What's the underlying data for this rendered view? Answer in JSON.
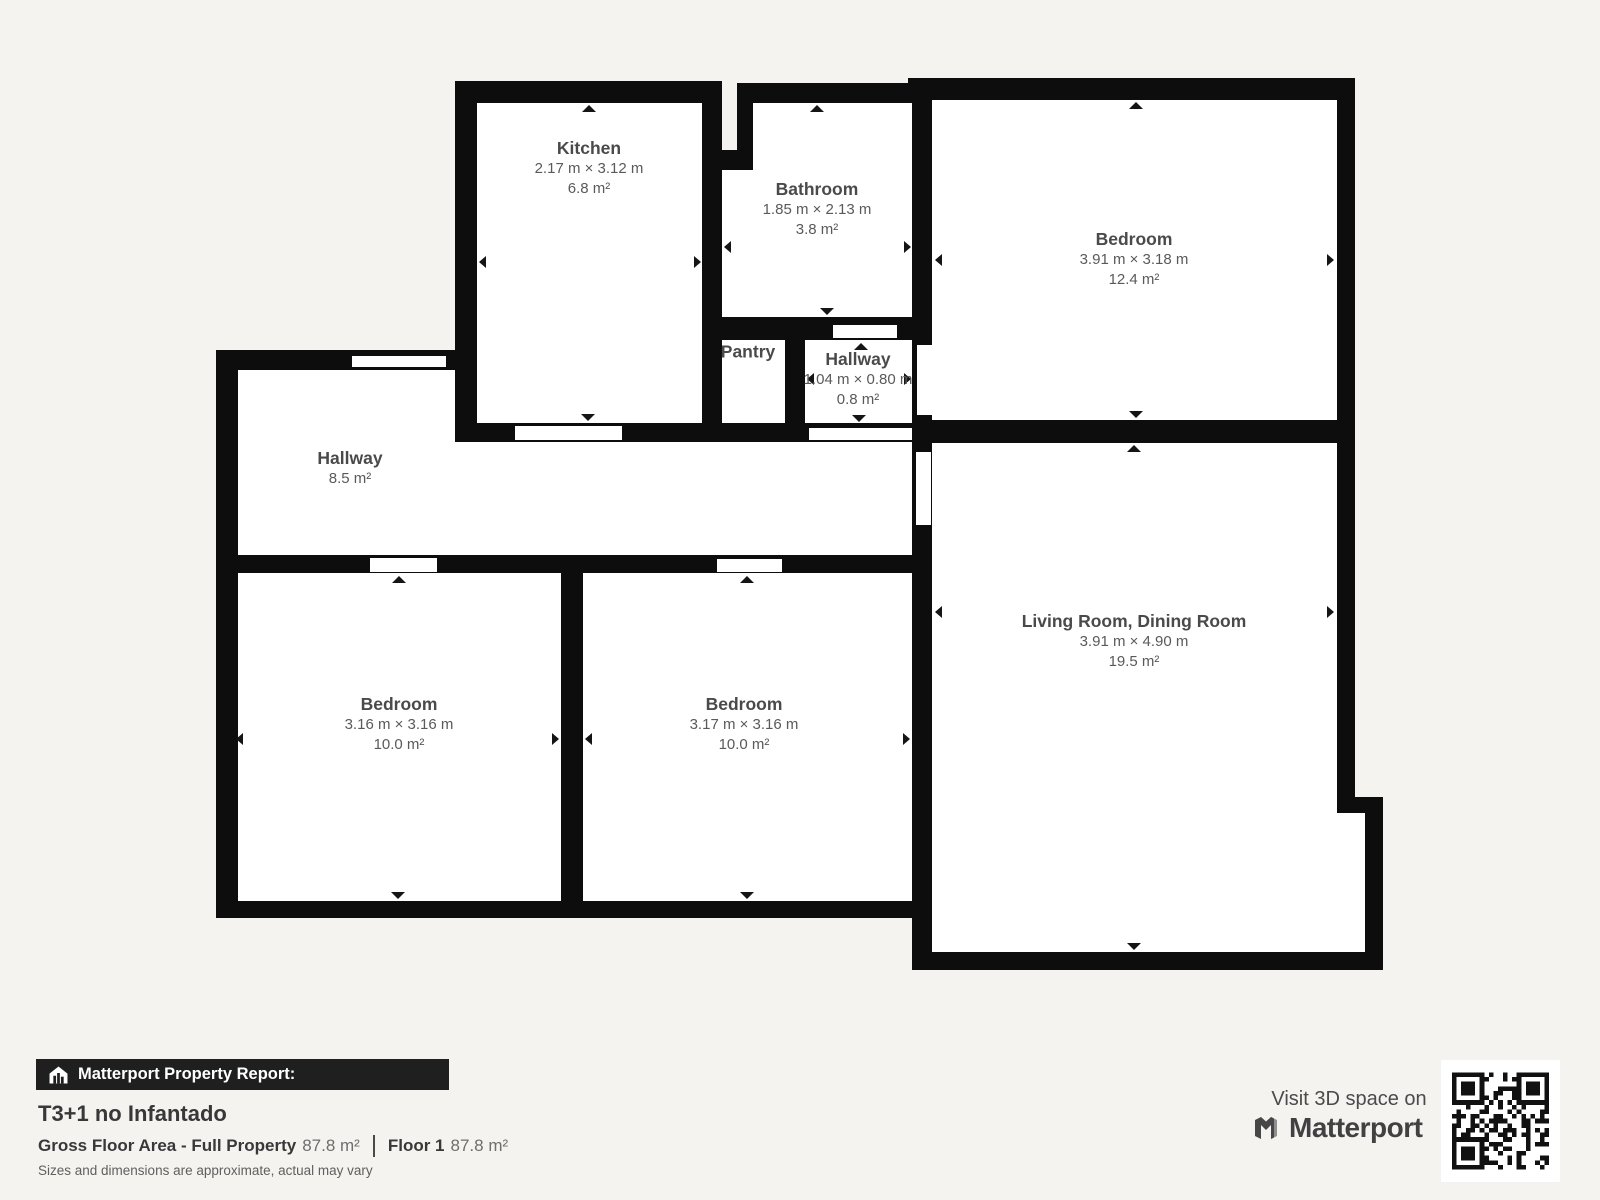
{
  "rooms": {
    "kitchen": {
      "name": "Kitchen",
      "dims": "2.17 m × 3.12 m",
      "area": "6.8 m²"
    },
    "bathroom": {
      "name": "Bathroom",
      "dims": "1.85 m × 2.13 m",
      "area": "3.8 m²"
    },
    "bedroom_top_right": {
      "name": "Bedroom",
      "dims": "3.91 m × 3.18 m",
      "area": "12.4 m²"
    },
    "pantry": {
      "name": "Pantry"
    },
    "hallway_small": {
      "name": "Hallway",
      "dims": "1.04 m × 0.80 m",
      "area": "0.8 m²"
    },
    "hallway_main": {
      "name": "Hallway",
      "area": "8.5 m²"
    },
    "bedroom_bottom_left": {
      "name": "Bedroom",
      "dims": "3.16 m × 3.16 m",
      "area": "10.0 m²"
    },
    "bedroom_bottom_middle": {
      "name": "Bedroom",
      "dims": "3.17 m × 3.16 m",
      "area": "10.0 m²"
    },
    "living_room": {
      "name": "Living Room, Dining Room",
      "dims": "3.91 m × 4.90 m",
      "area": "19.5 m²"
    }
  },
  "footer": {
    "report_label": "Matterport Property Report:",
    "title": "T3+1 no Infantado",
    "gross_label": "Gross Floor Area - Full Property",
    "gross_value": "87.8 m²",
    "floor_label": "Floor 1",
    "floor_value": "87.8 m²",
    "disclaimer": "Sizes and dimensions are approximate, actual may vary"
  },
  "promo": {
    "visit_text": "Visit 3D space on",
    "brand": "Matterport"
  },
  "colors": {
    "background": "#f4f3f0",
    "wall": "#0d0d0d",
    "room_fill": "#ffffff",
    "label_text": "#4a4a4a",
    "report_bar_bg": "#1f1f1f",
    "report_bar_text": "#ffffff"
  }
}
